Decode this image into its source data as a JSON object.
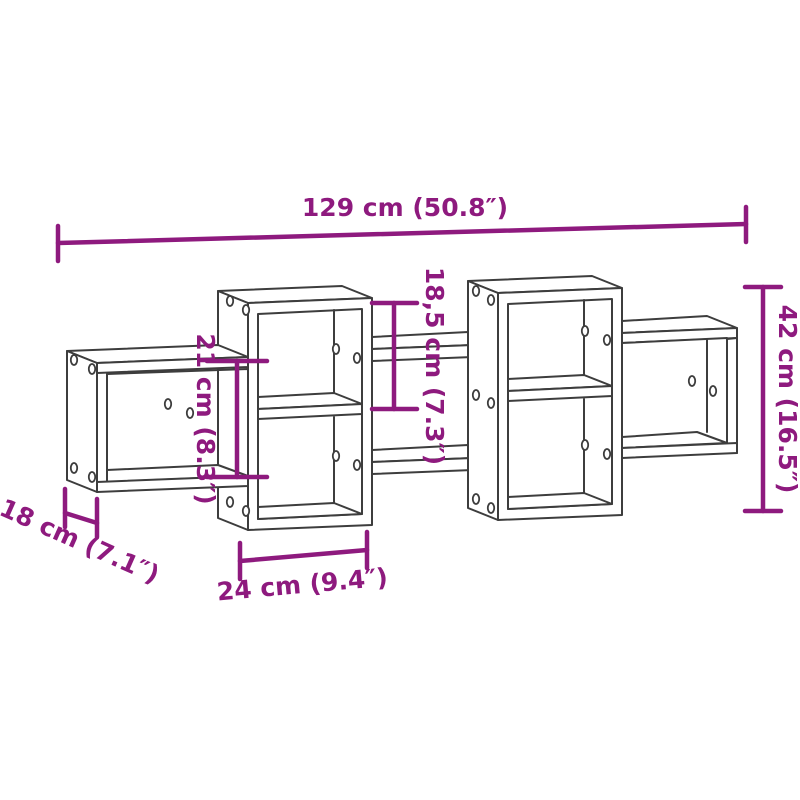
{
  "diagram": {
    "type": "product-dimension-diagram",
    "product": "wall-mounted cube shelf",
    "background_color": "#ffffff",
    "outline_color": "#3d3d3d",
    "dimension_color": "#8e1a7e",
    "dimensions": {
      "width": {
        "label": "129 cm (50.8″)",
        "cm": "129",
        "inch": "50.8"
      },
      "height": {
        "label": "42 cm (16.5″)",
        "cm": "42",
        "inch": "16.5"
      },
      "upper_compartment_height": {
        "label": "18,5 cm (7.3″)",
        "cm": "18,5",
        "inch": "7.3"
      },
      "left_compartment_height": {
        "label": "21 cm (8.3″)",
        "cm": "21",
        "inch": "8.3"
      },
      "depth": {
        "label": "18 cm (7.1″)",
        "cm": "18",
        "inch": "7.1"
      },
      "compartment_width": {
        "label": "24 cm (9.4″)",
        "cm": "24",
        "inch": "9.4"
      }
    }
  }
}
